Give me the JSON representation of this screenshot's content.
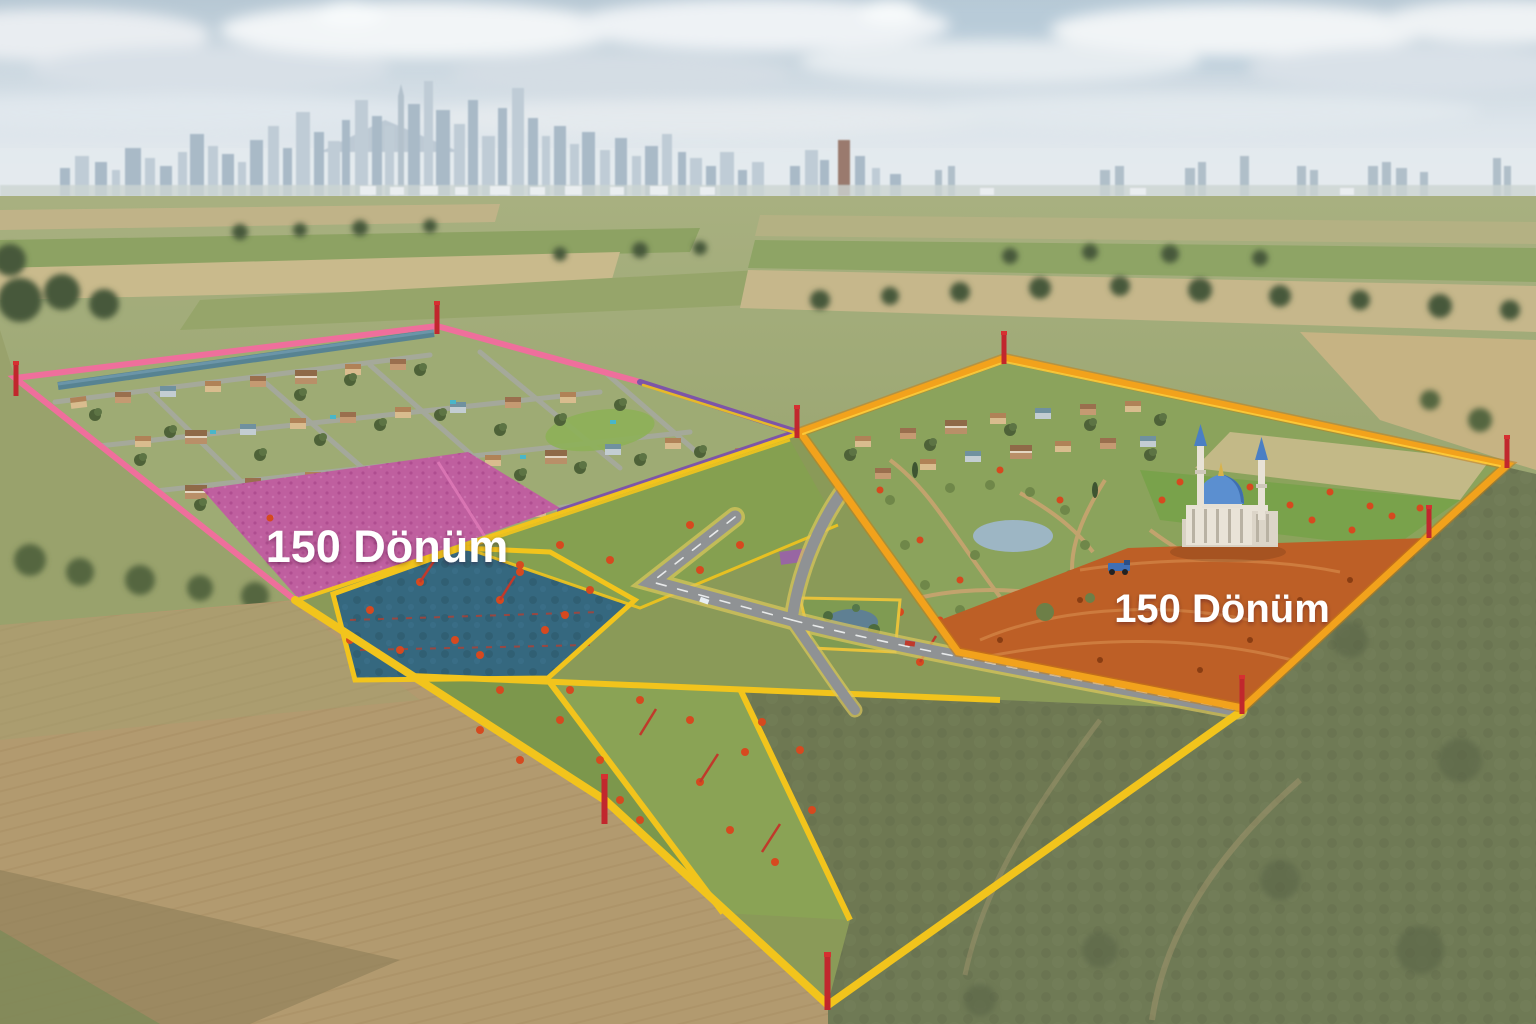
{
  "labels": {
    "west_parcel": "150 Dönüm",
    "east_parcel": "150 Dönüm"
  },
  "colors": {
    "boundary_pink": "#ef6f9c",
    "boundary_purple": "#7d55a8",
    "boundary_yellow": "#f2c41c",
    "boundary_orange": "#f2a21c",
    "field_magenta": "#bf5f9f",
    "field_teal": "#35687f",
    "field_orange": "#bd5f26",
    "stake_red": "#c1272d",
    "dome_blue": "#5b8fd0",
    "road_asphalt": "#8f9294",
    "label_text": "#ffffff"
  }
}
